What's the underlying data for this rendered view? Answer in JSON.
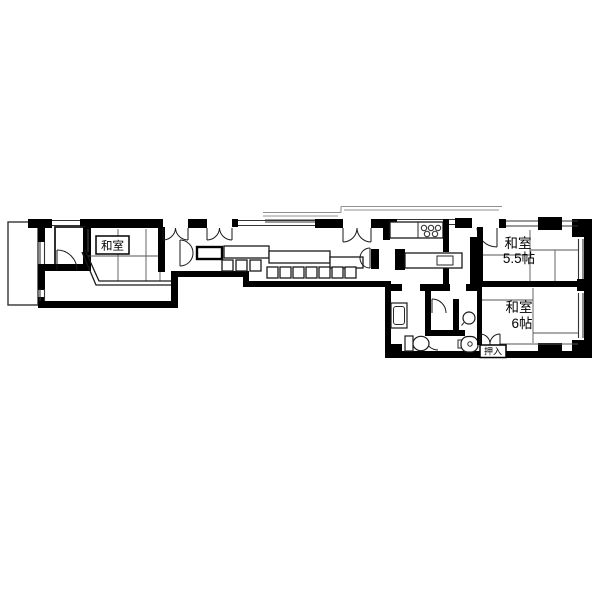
{
  "page": {
    "background": "#ffffff",
    "description": "apartment floor plan"
  },
  "floor_plan": {
    "type": "japanese-apartment-madori",
    "labels": {
      "washitsu_left": "和室",
      "washitsu_55_line1": "和室",
      "washitsu_55_line2": "5.5帖",
      "washitsu_6_line1": "和室",
      "washitsu_6_line2": "6帖",
      "oshiire": "押入"
    },
    "colors": {
      "wall": "#000000",
      "line": "#1a1a1a",
      "window_line": "#333333",
      "gray_line": "#909090",
      "background": "#ffffff"
    }
  }
}
